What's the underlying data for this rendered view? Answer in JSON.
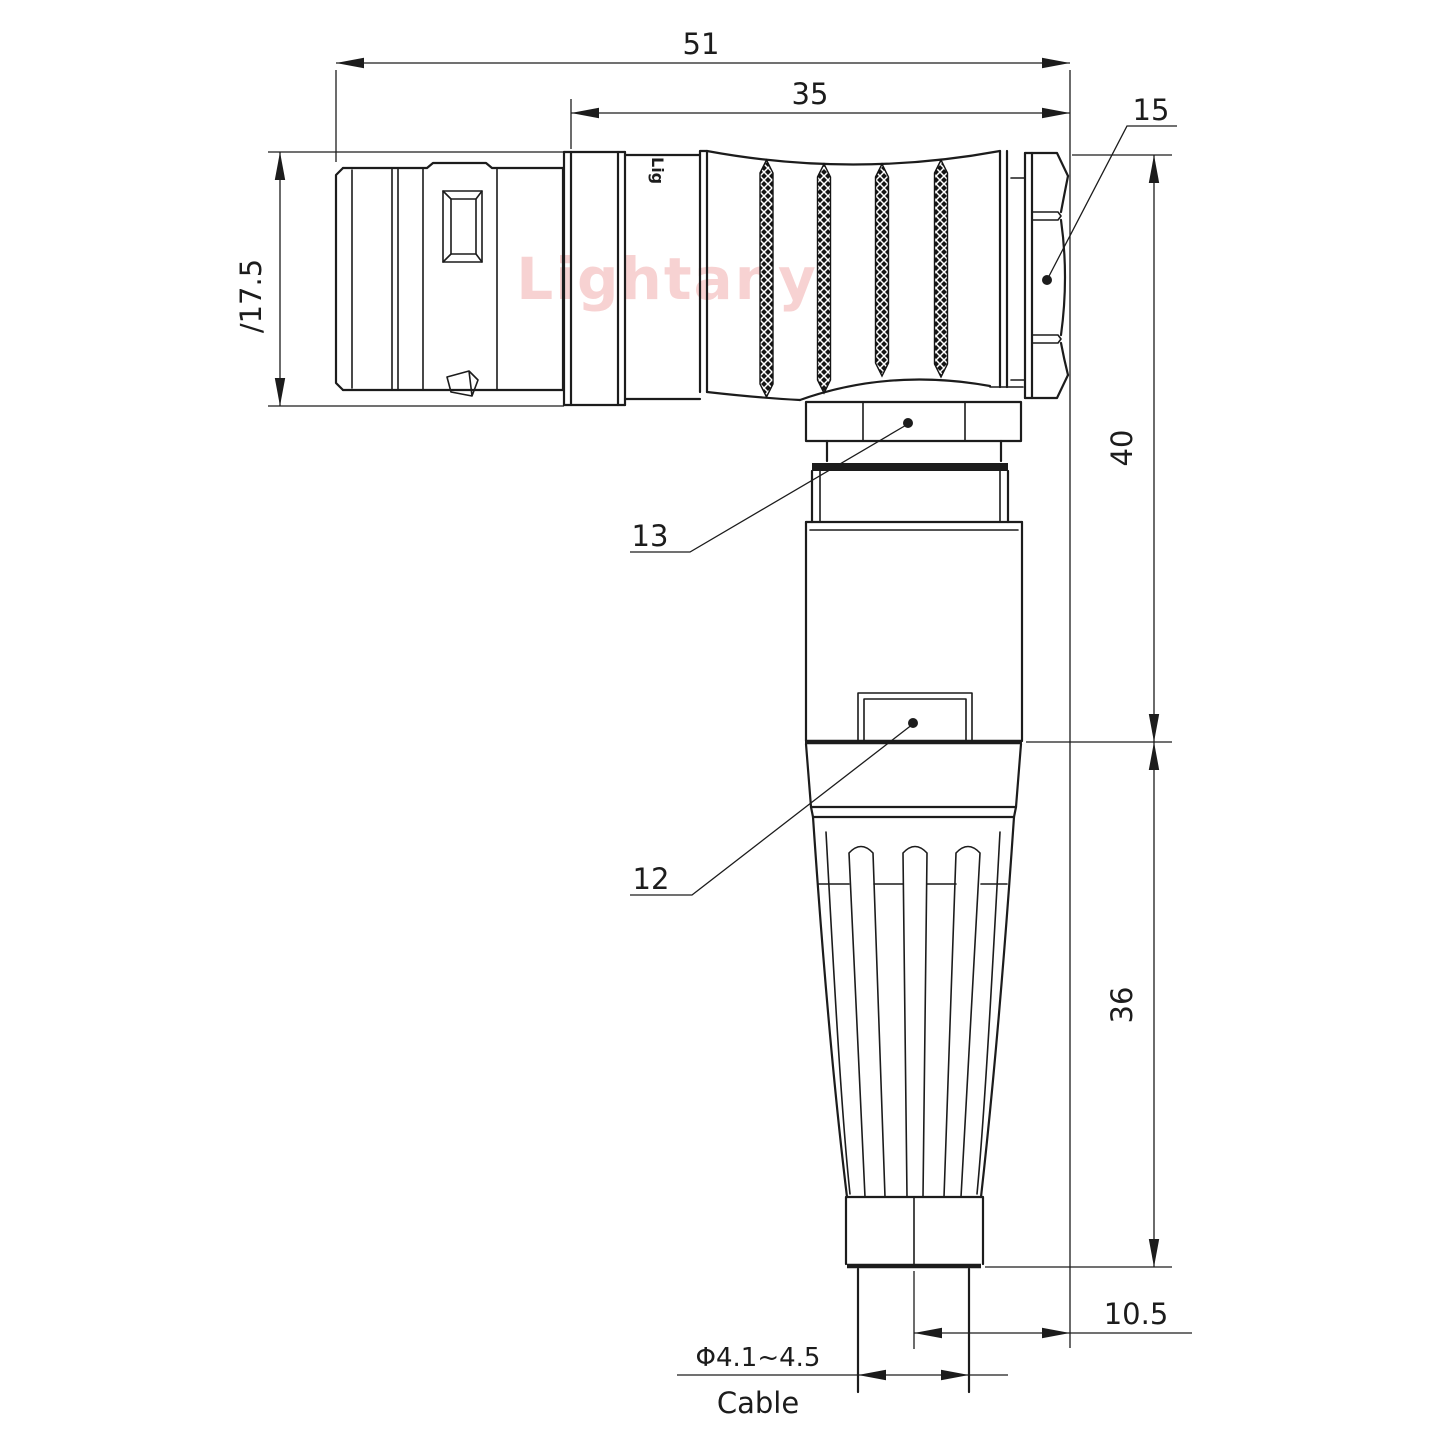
{
  "drawing": {
    "type": "right-angle circular connector, dimensioned outline drawing",
    "colors": {
      "line": "#1c1c1c",
      "background": "#ffffff",
      "watermark": "rgba(224,80,80,0.26)"
    },
    "dims": {
      "total_length": "51",
      "front_length": "35",
      "shell_diameter": "∕17.5",
      "rear_height": "40",
      "boot_height": "36",
      "axis_offset": "10.5",
      "cable_diameter": "Φ4.1~4.5",
      "cable_label": "Cable"
    },
    "callouts": {
      "hex_nut": "15",
      "coupling_nut": "13",
      "housing": "12"
    },
    "branding": {
      "watermark": "Lightany",
      "engraving": "Lig"
    }
  }
}
